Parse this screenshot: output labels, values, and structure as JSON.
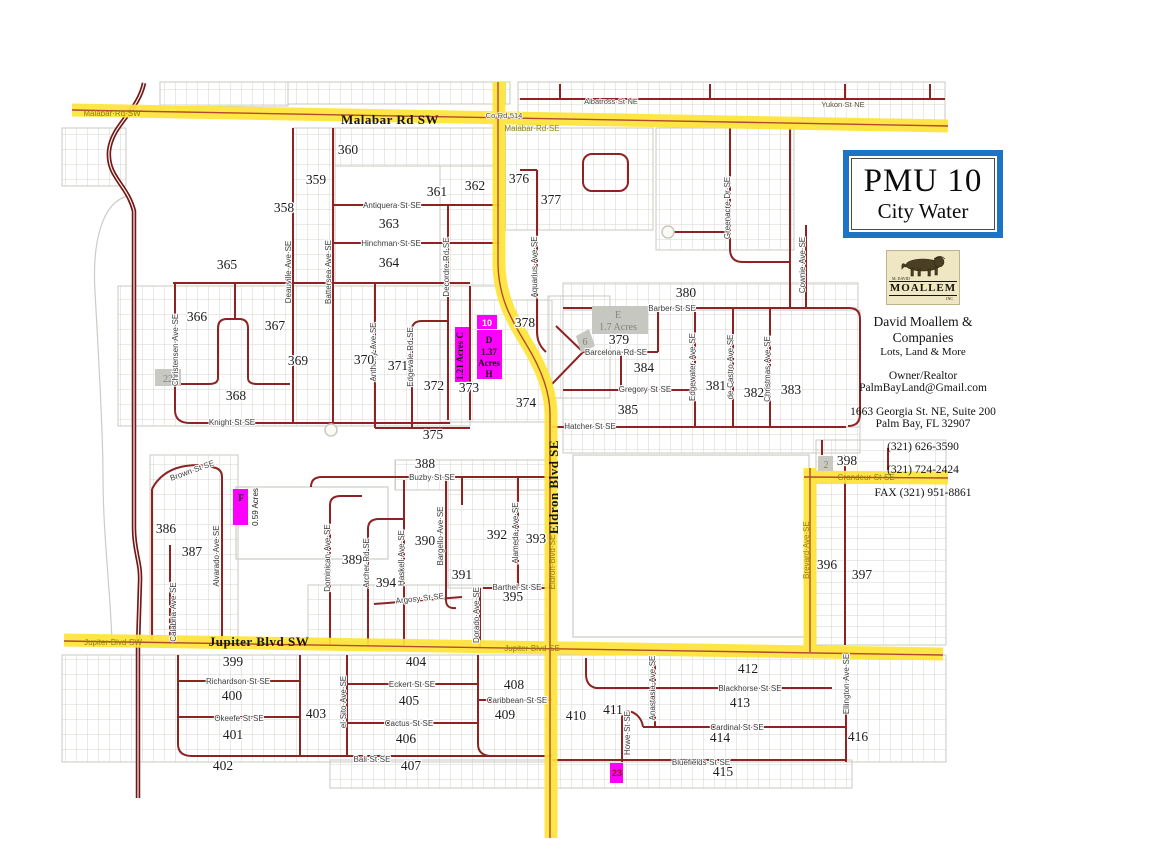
{
  "panel": {
    "title": "PMU 10",
    "subtitle": "City Water",
    "logo_top": "M. DAVID",
    "logo_brand": "MOALLEM",
    "logo_sub": "INC",
    "company": "David Moallem & Companies",
    "tagline": "Lots, Land & More",
    "role": "Owner/Realtor",
    "email": "PalmBayLand@Gmail.com",
    "address1": "1663 Georgia St. NE, Suite 200",
    "address2": "Palm Bay, FL   32907",
    "phone1": "(321) 626-3590",
    "phone2": "(321) 724-2424",
    "fax": "FAX (321) 951-8861"
  },
  "colors": {
    "highway_yellow": "#ffe437",
    "road_maroon": "#8e2323",
    "divided_road": "#731616",
    "parcel_magenta": "#fb00fb",
    "parcel_gray": "#c7c7c1",
    "title_border_blue": "#1d74c4",
    "logo_cream": "#efe6c3"
  },
  "map": {
    "street_labels": [
      {
        "t": "Albatross·St·NE",
        "x": 611,
        "y": 104,
        "c": "dk"
      },
      {
        "t": "Yukon·St·NE",
        "x": 843,
        "y": 107,
        "c": "dk"
      },
      {
        "t": "Malabar·Rd·SW",
        "x": 112,
        "y": 116,
        "c": "hw"
      },
      {
        "t": "Co·Rd·514",
        "x": 504,
        "y": 118,
        "c": "dk"
      },
      {
        "t": "Malabar·Rd·SE",
        "x": 532,
        "y": 131,
        "c": "hw"
      },
      {
        "t": "Malabar Rd SW",
        "x": 390,
        "y": 124,
        "c": "big"
      },
      {
        "t": "Antiquera·St·SE",
        "x": 392,
        "y": 208
      },
      {
        "t": "Hinchman·St·SE",
        "x": 391,
        "y": 246
      },
      {
        "t": "Knight·St·SE",
        "x": 232,
        "y": 425
      },
      {
        "t": "Christensen·Ave·SE",
        "x": 178,
        "y": 350,
        "r": -90
      },
      {
        "t": "Deauville·Ave·SE",
        "x": 291,
        "y": 272,
        "r": -90
      },
      {
        "t": "Battersea·Ave·SE",
        "x": 331,
        "y": 272,
        "r": -90
      },
      {
        "t": "Anthony·Ave·SE",
        "x": 376,
        "y": 352,
        "r": -90
      },
      {
        "t": "Edgevale·Rd·SE",
        "x": 413,
        "y": 357,
        "r": -90
      },
      {
        "t": "Decordre·Rd·SE",
        "x": 449,
        "y": 267,
        "r": -90
      },
      {
        "t": "Aquarius·Ave·SE",
        "x": 537,
        "y": 267,
        "r": -90
      },
      {
        "t": "Greenacre·Dr·SE",
        "x": 730,
        "y": 208,
        "r": -90
      },
      {
        "t": "Cownie·Ave·SE",
        "x": 805,
        "y": 265,
        "r": -90
      },
      {
        "t": "Barber·St·SE",
        "x": 672,
        "y": 311
      },
      {
        "t": "Barcelona·Rd·SE",
        "x": 616,
        "y": 355
      },
      {
        "t": "Gregory·St·SE",
        "x": 645,
        "y": 392
      },
      {
        "t": "Hatcher·St·SE",
        "x": 590,
        "y": 429
      },
      {
        "t": "Edgewater·Ave·SE",
        "x": 695,
        "y": 367,
        "r": -90
      },
      {
        "t": "de·Castro·Ave·SE",
        "x": 733,
        "y": 367,
        "r": -90
      },
      {
        "t": "Christmas·Ave·SE",
        "x": 770,
        "y": 369,
        "r": -90
      },
      {
        "t": "Eldron Blvd SE",
        "x": 558,
        "y": 487,
        "r": -90,
        "c": "big"
      },
      {
        "t": "Eldron·Blvd·SE",
        "x": 555,
        "y": 562,
        "r": -90,
        "c": "hw"
      },
      {
        "t": "Grandeur·St·SE",
        "x": 866,
        "y": 480,
        "c": "hw"
      },
      {
        "t": "Brevard·Ave·SE",
        "x": 809,
        "y": 550,
        "r": -90,
        "c": "hw"
      },
      {
        "t": "Buzby·St·SE",
        "x": 432,
        "y": 480
      },
      {
        "t": "Brown·St·SE",
        "x": 193,
        "y": 473,
        "r": -20
      },
      {
        "t": "Calabria·Ave·SE",
        "x": 176,
        "y": 612,
        "r": -90
      },
      {
        "t": "Alvarado·Ave·SE",
        "x": 219,
        "y": 556,
        "r": -90
      },
      {
        "t": "Dominican·Ave·SE",
        "x": 330,
        "y": 558,
        "r": -90
      },
      {
        "t": "Archer·Rd·SE",
        "x": 369,
        "y": 563,
        "r": -90
      },
      {
        "t": "Haskell·Ave·SE",
        "x": 404,
        "y": 558,
        "r": -90
      },
      {
        "t": "Bargello·Ave·SE",
        "x": 443,
        "y": 536,
        "r": -90
      },
      {
        "t": "Alameda·Ave·SE",
        "x": 518,
        "y": 533,
        "r": -90
      },
      {
        "t": "Dorado·Ave·SE",
        "x": 479,
        "y": 615,
        "r": -90
      },
      {
        "t": "Argosy·St·SE",
        "x": 420,
        "y": 601,
        "r": -6
      },
      {
        "t": "Barthel·St·SE",
        "x": 517,
        "y": 590
      },
      {
        "t": "Jupiter·Blvd·SW",
        "x": 113,
        "y": 645,
        "c": "hw"
      },
      {
        "t": "Jupiter Blvd SW",
        "x": 259,
        "y": 646,
        "c": "big"
      },
      {
        "t": "Jupiter·Blvd·SE",
        "x": 532,
        "y": 651,
        "c": "hw"
      },
      {
        "t": "Richardson·St·SE",
        "x": 238,
        "y": 684
      },
      {
        "t": "Okeefe·St·SE",
        "x": 239,
        "y": 721
      },
      {
        "t": "Eckert·St·SE",
        "x": 412,
        "y": 687
      },
      {
        "t": "Cactus·St·SE",
        "x": 409,
        "y": 726
      },
      {
        "t": "Bali·St·SE",
        "x": 372,
        "y": 762
      },
      {
        "t": "el·Sito·Ave·SE",
        "x": 346,
        "y": 702,
        "r": -90
      },
      {
        "t": "Caribbean·St·SE",
        "x": 517,
        "y": 703
      },
      {
        "t": "Blackhorse·St·SE",
        "x": 750,
        "y": 691
      },
      {
        "t": "Cardinal·St·SE",
        "x": 737,
        "y": 730
      },
      {
        "t": "Bluefields·St·SE",
        "x": 701,
        "y": 765
      },
      {
        "t": "Anastasia·Ave·SE",
        "x": 655,
        "y": 688,
        "r": -90
      },
      {
        "t": "Howe·St·SE",
        "x": 630,
        "y": 733,
        "r": -90
      },
      {
        "t": "Ellington·Ave·SE",
        "x": 849,
        "y": 684,
        "r": -90
      }
    ],
    "block_numbers": [
      {
        "n": "358",
        "x": 284,
        "y": 212
      },
      {
        "n": "359",
        "x": 316,
        "y": 184
      },
      {
        "n": "360",
        "x": 348,
        "y": 154
      },
      {
        "n": "361",
        "x": 437,
        "y": 196
      },
      {
        "n": "362",
        "x": 475,
        "y": 190
      },
      {
        "n": "363",
        "x": 389,
        "y": 228
      },
      {
        "n": "364",
        "x": 389,
        "y": 267
      },
      {
        "n": "365",
        "x": 227,
        "y": 269
      },
      {
        "n": "366",
        "x": 197,
        "y": 321
      },
      {
        "n": "367",
        "x": 275,
        "y": 330
      },
      {
        "n": "368",
        "x": 236,
        "y": 400
      },
      {
        "n": "369",
        "x": 298,
        "y": 365
      },
      {
        "n": "370",
        "x": 364,
        "y": 364
      },
      {
        "n": "371",
        "x": 398,
        "y": 370
      },
      {
        "n": "372",
        "x": 434,
        "y": 390
      },
      {
        "n": "373",
        "x": 469,
        "y": 392
      },
      {
        "n": "374",
        "x": 526,
        "y": 407
      },
      {
        "n": "375",
        "x": 433,
        "y": 439
      },
      {
        "n": "376",
        "x": 519,
        "y": 183
      },
      {
        "n": "377",
        "x": 551,
        "y": 204
      },
      {
        "n": "378",
        "x": 525,
        "y": 327
      },
      {
        "n": "379",
        "x": 619,
        "y": 344
      },
      {
        "n": "380",
        "x": 686,
        "y": 297
      },
      {
        "n": "381",
        "x": 716,
        "y": 390
      },
      {
        "n": "382",
        "x": 754,
        "y": 397
      },
      {
        "n": "383",
        "x": 791,
        "y": 394
      },
      {
        "n": "384",
        "x": 644,
        "y": 372
      },
      {
        "n": "385",
        "x": 628,
        "y": 414
      },
      {
        "n": "386",
        "x": 166,
        "y": 533
      },
      {
        "n": "387",
        "x": 192,
        "y": 556
      },
      {
        "n": "388",
        "x": 425,
        "y": 468
      },
      {
        "n": "389",
        "x": 352,
        "y": 564
      },
      {
        "n": "390",
        "x": 425,
        "y": 545
      },
      {
        "n": "391",
        "x": 462,
        "y": 579
      },
      {
        "n": "392",
        "x": 497,
        "y": 539
      },
      {
        "n": "393",
        "x": 536,
        "y": 543
      },
      {
        "n": "394",
        "x": 386,
        "y": 587
      },
      {
        "n": "395",
        "x": 513,
        "y": 601
      },
      {
        "n": "396",
        "x": 827,
        "y": 569
      },
      {
        "n": "397",
        "x": 862,
        "y": 579
      },
      {
        "n": "398",
        "x": 847,
        "y": 465
      },
      {
        "n": "399",
        "x": 233,
        "y": 666
      },
      {
        "n": "400",
        "x": 232,
        "y": 700
      },
      {
        "n": "401",
        "x": 233,
        "y": 739
      },
      {
        "n": "402",
        "x": 223,
        "y": 770
      },
      {
        "n": "403",
        "x": 316,
        "y": 718
      },
      {
        "n": "404",
        "x": 416,
        "y": 666
      },
      {
        "n": "405",
        "x": 409,
        "y": 705
      },
      {
        "n": "406",
        "x": 406,
        "y": 743
      },
      {
        "n": "407",
        "x": 411,
        "y": 770
      },
      {
        "n": "408",
        "x": 514,
        "y": 689
      },
      {
        "n": "409",
        "x": 505,
        "y": 719
      },
      {
        "n": "410",
        "x": 576,
        "y": 720
      },
      {
        "n": "411",
        "x": 613,
        "y": 714
      },
      {
        "n": "412",
        "x": 748,
        "y": 673
      },
      {
        "n": "413",
        "x": 740,
        "y": 707
      },
      {
        "n": "414",
        "x": 720,
        "y": 742
      },
      {
        "n": "415",
        "x": 723,
        "y": 776
      },
      {
        "n": "416",
        "x": 858,
        "y": 741
      }
    ],
    "parcels": [
      {
        "shape": "rect",
        "x": 455,
        "y": 327,
        "w": 14,
        "h": 55,
        "fill": "#fb00fb",
        "texts": [
          {
            "t": "1.21 Acres C",
            "x": 463,
            "y": 356,
            "r": -90,
            "c": "pb"
          }
        ]
      },
      {
        "shape": "rect",
        "x": 477,
        "y": 330,
        "w": 25,
        "h": 49,
        "fill": "#fb00fb",
        "texts": [
          {
            "t": "D",
            "x": 489,
            "y": 343,
            "c": "pb"
          },
          {
            "t": "1.37",
            "x": 489,
            "y": 355,
            "c": "pb"
          },
          {
            "t": "Acres",
            "x": 489,
            "y": 366,
            "c": "pb"
          },
          {
            "t": "H",
            "x": 489,
            "y": 377,
            "c": "pb"
          }
        ]
      },
      {
        "shape": "rect",
        "x": 477,
        "y": 315,
        "w": 20,
        "h": 14,
        "fill": "#fb00fb",
        "texts": [
          {
            "t": "10",
            "x": 487,
            "y": 326,
            "c": "pw"
          }
        ]
      },
      {
        "shape": "rect",
        "x": 233,
        "y": 489,
        "w": 15,
        "h": 36,
        "fill": "#fb00fb",
        "texts": [
          {
            "t": "F",
            "x": 241,
            "y": 501,
            "c": "pb"
          },
          {
            "t": "0.59 Acres",
            "x": 258,
            "y": 507,
            "r": -90,
            "c": "pb2"
          }
        ]
      },
      {
        "shape": "rect",
        "x": 610,
        "y": 763,
        "w": 13,
        "h": 20,
        "fill": "#fb00fb",
        "texts": [
          {
            "t": "23",
            "x": 617,
            "y": 776,
            "c": "pr"
          }
        ]
      },
      {
        "shape": "rect",
        "x": 592,
        "y": 306,
        "w": 56,
        "h": 28,
        "fill": "#c7c7c1",
        "texts": [
          {
            "t": "E",
            "x": 618,
            "y": 318,
            "c": "pg"
          },
          {
            "t": "1.7 Acres",
            "x": 618,
            "y": 330,
            "c": "pg"
          }
        ]
      },
      {
        "shape": "poly",
        "points": "576,336 589,329 595,346 581,353",
        "fill": "#c7c7c1",
        "texts": [
          {
            "t": "6",
            "x": 585,
            "y": 345,
            "c": "pg"
          }
        ]
      },
      {
        "shape": "rect",
        "x": 155,
        "y": 369,
        "w": 26,
        "h": 17,
        "fill": "#c9c9c3",
        "texts": [
          {
            "t": "22",
            "x": 168,
            "y": 382,
            "c": "pg"
          }
        ]
      },
      {
        "shape": "rect",
        "x": 818,
        "y": 456,
        "w": 15,
        "h": 15,
        "fill": "#c9c9c3",
        "texts": [
          {
            "t": "2",
            "x": 826,
            "y": 468,
            "c": "pg"
          }
        ]
      }
    ]
  }
}
